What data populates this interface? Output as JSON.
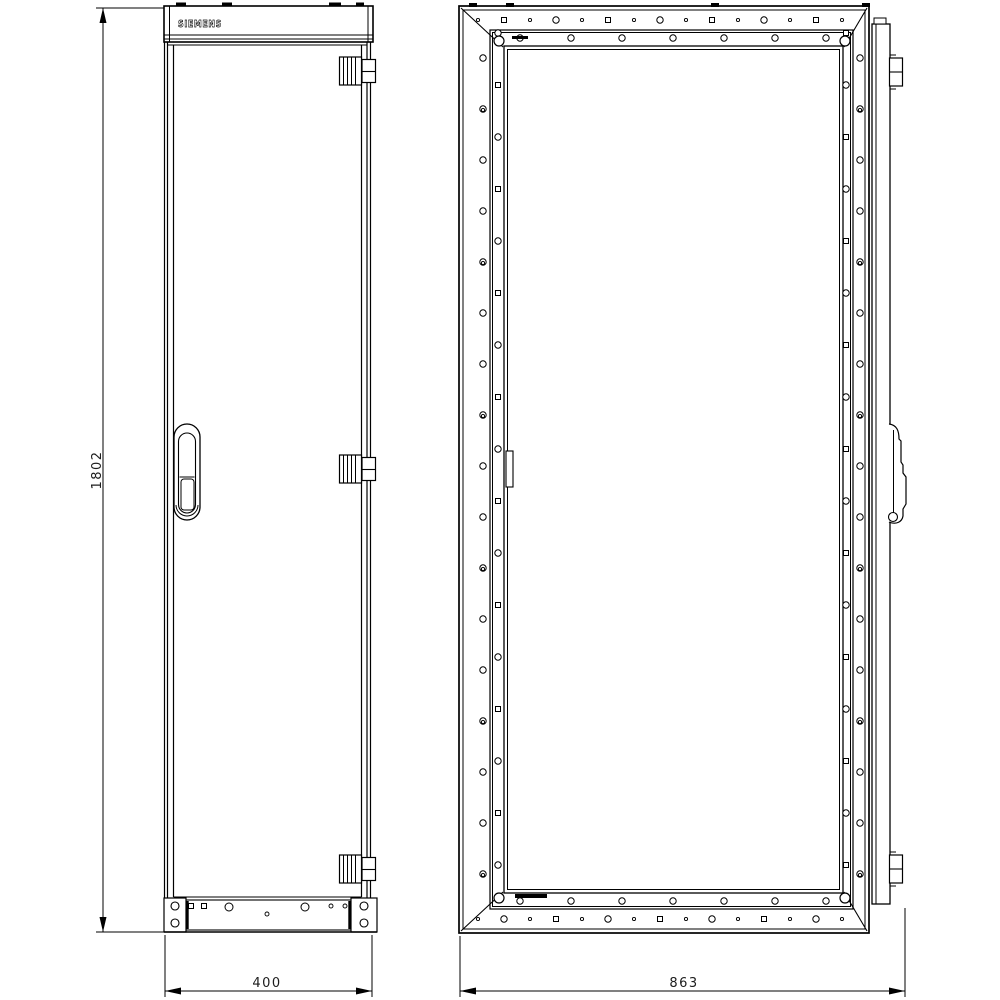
{
  "brand": {
    "logo_text": "SIEMENS"
  },
  "dimensions": {
    "height_label": "1802",
    "front_width_label": "400",
    "rear_width_label": "863"
  },
  "colors": {
    "line": "#000000",
    "background": "#ffffff"
  },
  "drawing": {
    "front_view": {
      "panel": {
        "x": 164,
        "y": 6,
        "w": 209,
        "h": 36
      },
      "panel_hlines": [
        35,
        39
      ],
      "panel_vlines": [
        169.5,
        368
      ],
      "top_notches": [
        [
          176,
          10
        ],
        [
          222,
          10
        ],
        [
          329,
          12
        ],
        [
          356,
          8
        ]
      ],
      "body": {
        "left_lines": [
          164.5,
          167.5
        ],
        "door_left": 173.5,
        "door_right": 361.5,
        "right_lines": [
          367,
          370.5
        ],
        "top": 42,
        "door_top": 45,
        "door_bottom": 897,
        "bottom": 932
      },
      "handle": {
        "x": 174,
        "y": 424,
        "w": 26,
        "h": 96
      },
      "hinges_y": [
        57,
        455,
        855
      ],
      "base": {
        "left_block": [
          164,
          898,
          22,
          34
        ],
        "right_block": [
          351,
          898,
          26,
          34
        ],
        "plate": [
          186,
          900,
          165,
          30
        ],
        "thick_x": [
          187.5,
          349.5
        ],
        "block_holes": [
          [
            175,
            906
          ],
          [
            175,
            923
          ],
          [
            364,
            906
          ],
          [
            364,
            923
          ]
        ],
        "plate_squares": [
          [
            191,
            906
          ],
          [
            204,
            906
          ]
        ],
        "plate_circles": [
          [
            229,
            907
          ],
          [
            305,
            907
          ]
        ],
        "plate_tiny": [
          [
            267,
            914
          ],
          [
            331,
            906
          ],
          [
            345,
            906
          ]
        ]
      }
    },
    "rear_view": {
      "outer": [
        459,
        6,
        410,
        927
      ],
      "outer_inner": [
        463,
        10,
        402,
        919
      ],
      "rail": [
        490,
        30,
        363,
        879
      ],
      "rail_inner": [
        492.5,
        32.5,
        358,
        874
      ],
      "opening": [
        504,
        46,
        339,
        847
      ],
      "opening_inner": [
        507.5,
        49.5,
        332,
        840
      ],
      "corner_diagonals": [
        [
          461,
          8,
          503,
          47
        ],
        [
          867,
          8,
          844,
          47
        ],
        [
          461,
          931,
          503,
          892
        ],
        [
          867,
          931,
          844,
          892
        ]
      ],
      "corner_circles": [
        [
          499,
          41
        ],
        [
          845,
          41
        ],
        [
          499,
          898
        ],
        [
          845,
          898
        ]
      ],
      "corner_circle_r": 5,
      "hole_rows": [
        {
          "axis": "h",
          "pos": 20,
          "start": 478,
          "step": 26,
          "count": 15,
          "cycle": [
            "tiny",
            "square",
            "tiny",
            "circle"
          ]
        },
        {
          "axis": "h",
          "pos": 38,
          "start": 520,
          "step": 51,
          "count": 7,
          "cycle": [
            "circle"
          ]
        },
        {
          "axis": "h",
          "pos": 901,
          "start": 520,
          "step": 51,
          "count": 7,
          "cycle": [
            "circle"
          ]
        },
        {
          "axis": "h",
          "pos": 919,
          "start": 478,
          "step": 26,
          "count": 15,
          "cycle": [
            "tiny",
            "circle",
            "tiny",
            "square"
          ]
        },
        {
          "axis": "v",
          "pos": 483,
          "start": 58,
          "step": 51,
          "count": 17,
          "cycle": [
            "circle"
          ]
        },
        {
          "axis": "v",
          "pos": 483,
          "start": 110,
          "step": 153,
          "count": 6,
          "cycle": [
            "tiny"
          ]
        },
        {
          "axis": "v",
          "pos": 498,
          "start": 33,
          "step": 52,
          "count": 17,
          "cycle": [
            "circle",
            "square"
          ]
        },
        {
          "axis": "v",
          "pos": 860,
          "start": 58,
          "step": 51,
          "count": 17,
          "cycle": [
            "circle"
          ]
        },
        {
          "axis": "v",
          "pos": 860,
          "start": 110,
          "step": 153,
          "count": 6,
          "cycle": [
            "tiny"
          ]
        },
        {
          "axis": "v",
          "pos": 846,
          "start": 33,
          "step": 52,
          "count": 17,
          "cycle": [
            "square",
            "circle"
          ]
        }
      ],
      "top_notches": [
        [
          469,
          8
        ],
        [
          506,
          8
        ],
        [
          711,
          8
        ],
        [
          862,
          8
        ]
      ],
      "bars": [
        [
          512,
          36,
          16,
          3
        ],
        [
          515,
          894,
          32,
          4
        ]
      ],
      "latch": [
        506,
        451,
        7,
        36
      ],
      "door_strip": {
        "x": 872,
        "y": 24,
        "w": 18,
        "h": 880,
        "inner_x": 876,
        "step": [
          874,
          18,
          12,
          6
        ]
      },
      "strip_hinges_y": [
        58,
        855
      ],
      "handle_y": 424
    },
    "dims": {
      "height": {
        "line_x": 103,
        "y1": 8,
        "y2": 932,
        "ext": [
          [
            96,
            8,
            164,
            8
          ],
          [
            96,
            932,
            164,
            932
          ]
        ],
        "label_x": 96,
        "label_y": 470
      },
      "width_front": {
        "line_y": 991,
        "x1": 165,
        "x2": 372,
        "ext": [
          [
            165,
            935,
            165,
            997
          ],
          [
            372,
            935,
            372,
            997
          ]
        ],
        "label_x": 267,
        "label_y": 987
      },
      "width_rear": {
        "line_y": 991,
        "x1": 460,
        "x2": 905,
        "ext": [
          [
            460,
            936,
            460,
            997
          ],
          [
            905,
            908,
            905,
            997
          ]
        ],
        "label_x": 684,
        "label_y": 987
      }
    }
  }
}
